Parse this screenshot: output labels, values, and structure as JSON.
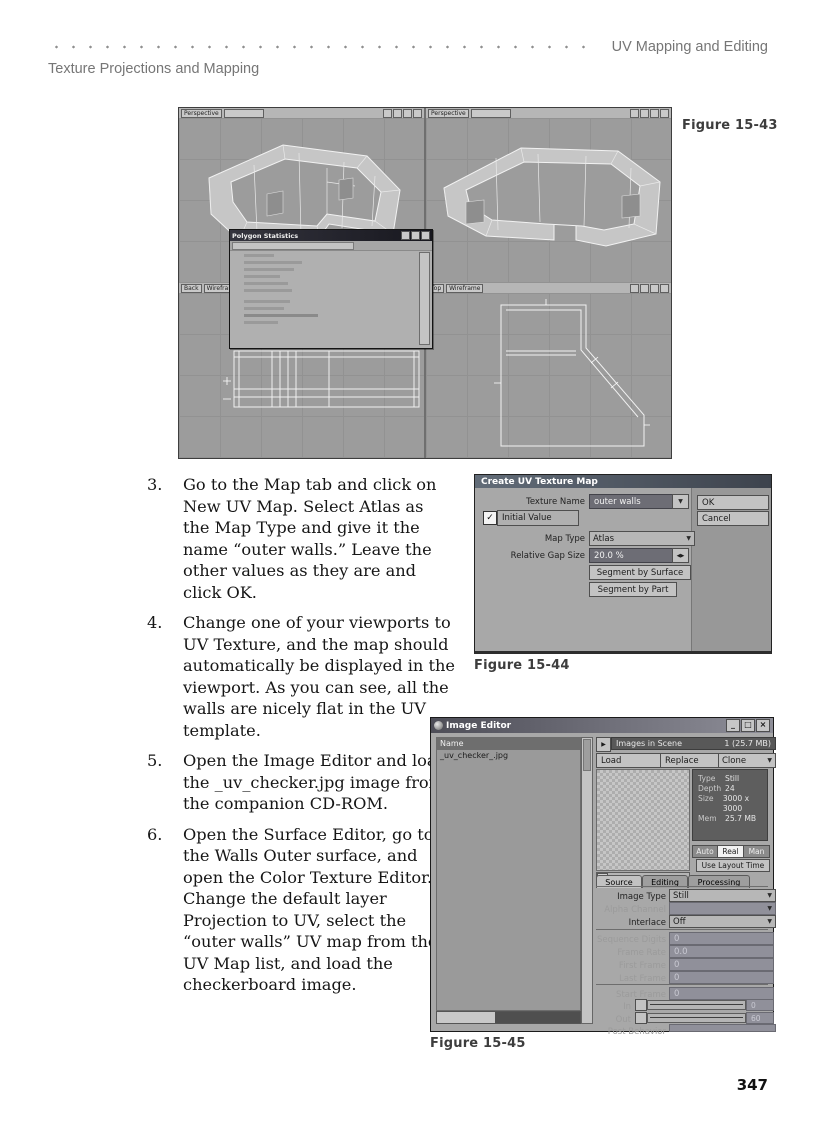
{
  "header": {
    "right": "UV Mapping and Editing",
    "left": "Texture Projections and Mapping"
  },
  "page_number": "347",
  "steps": [
    {
      "num": "3.",
      "text": "Go to the Map tab and click on New UV Map. Select Atlas as the Map Type and give it the name “outer walls.” Leave the other values as they are and click OK."
    },
    {
      "num": "4.",
      "text": "Change one of your viewports to UV Texture, and the map should automatically be displayed in the viewport. As you can see, all the walls are nicely flat in the UV template."
    },
    {
      "num": "5.",
      "text": "Open the Image Editor and load the _uv_checker.jpg image from the companion CD-ROM."
    },
    {
      "num": "6.",
      "text": "Open the Surface Editor, go to the Walls Outer surface, and open the Color Texture Editor. Change the default layer Projection to UV, select the “outer walls” UV map from the UV Map list, and load the checkerboard image."
    }
  ],
  "captions": {
    "fig43": "Figure 15-43",
    "fig44": "Figure 15-44",
    "fig45": "Figure 15-45"
  },
  "modeler": {
    "stats_title": "Polygon Statistics",
    "viewports": {
      "tl": "Perspective",
      "tr": "Perspective",
      "bl": "Back",
      "bl_mode": "Wireframe",
      "br": "Top",
      "br_mode": "Wireframe"
    }
  },
  "uv_dialog": {
    "title": "Create UV Texture Map",
    "texture_name_label": "Texture Name",
    "texture_name_value": "outer walls",
    "initial_value_label": "Initial Value",
    "map_type_label": "Map Type",
    "map_type_value": "Atlas",
    "gap_label": "Relative Gap Size",
    "gap_value": "20.0 %",
    "segment_by_surface": "Segment by Surface",
    "segment_by_part": "Segment by Part",
    "ok": "OK",
    "cancel": "Cancel"
  },
  "image_editor": {
    "title": "Image Editor",
    "name_header": "Name",
    "file_name": "_uv_checker_.jpg",
    "images_in_scene": "Images in Scene",
    "images_total": "1 (25.7 MB)",
    "load": "Load",
    "replace": "Replace",
    "clone": "Clone",
    "info": {
      "type_label": "Type",
      "type_value": "Still",
      "depth_label": "Depth",
      "depth_value": "24",
      "size_label": "Size",
      "size_value": "3000 x 3000",
      "mem_label": "Mem",
      "mem_value": "25.7 MB"
    },
    "auto": "Auto",
    "real": "Real",
    "man": "Man",
    "use_layout_time": "Use Layout Time",
    "tabs": [
      "Source",
      "Editing",
      "Processing"
    ],
    "image_type_label": "Image Type",
    "image_type_value": "Still",
    "alpha_channel_label": "Alpha Channel",
    "interlace_label": "Interlace",
    "interlace_value": "Off",
    "sequence_digits_label": "Sequence Digits",
    "sequence_digits_value": "0",
    "frame_rate_label": "Frame Rate",
    "frame_rate_value": "0.0",
    "first_frame_label": "First Frame",
    "first_frame_value": "0",
    "last_frame_label": "Last Frame",
    "last_frame_value": "0",
    "start_frame_label": "Start Frame",
    "start_frame_value": "0",
    "in_label": "In",
    "in_value": "0",
    "out_label": "Out",
    "out_value": "60",
    "post_behavior_label": "Post Behavior"
  },
  "icons": {
    "dropdown": "▼",
    "spinner": "◀▶",
    "play": "▶",
    "check": "✓",
    "minimize": "_",
    "maximize": "□",
    "close": "×"
  }
}
